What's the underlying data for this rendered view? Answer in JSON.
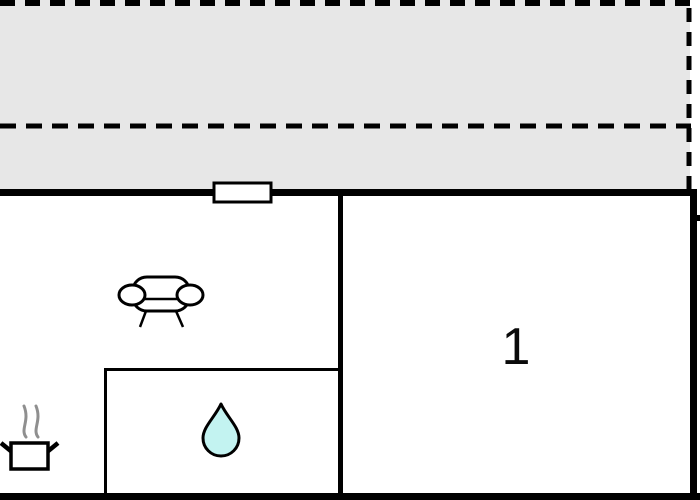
{
  "floorplan": {
    "rooms": [
      {
        "label": "1"
      }
    ],
    "icons": {
      "sofa": "sofa-icon",
      "cooking_pot": "cooking-pot-icon",
      "water_drop": "water-drop-icon",
      "window": "window-symbol"
    },
    "colors": {
      "background": "#ffffff",
      "terrace_fill": "#e7e7e7",
      "wall": "#000000",
      "line": "#000000",
      "water_drop_fill": "#c3f3f1",
      "steam_gray": "#8f8f8f",
      "label_text": "#0a0a0a"
    }
  }
}
